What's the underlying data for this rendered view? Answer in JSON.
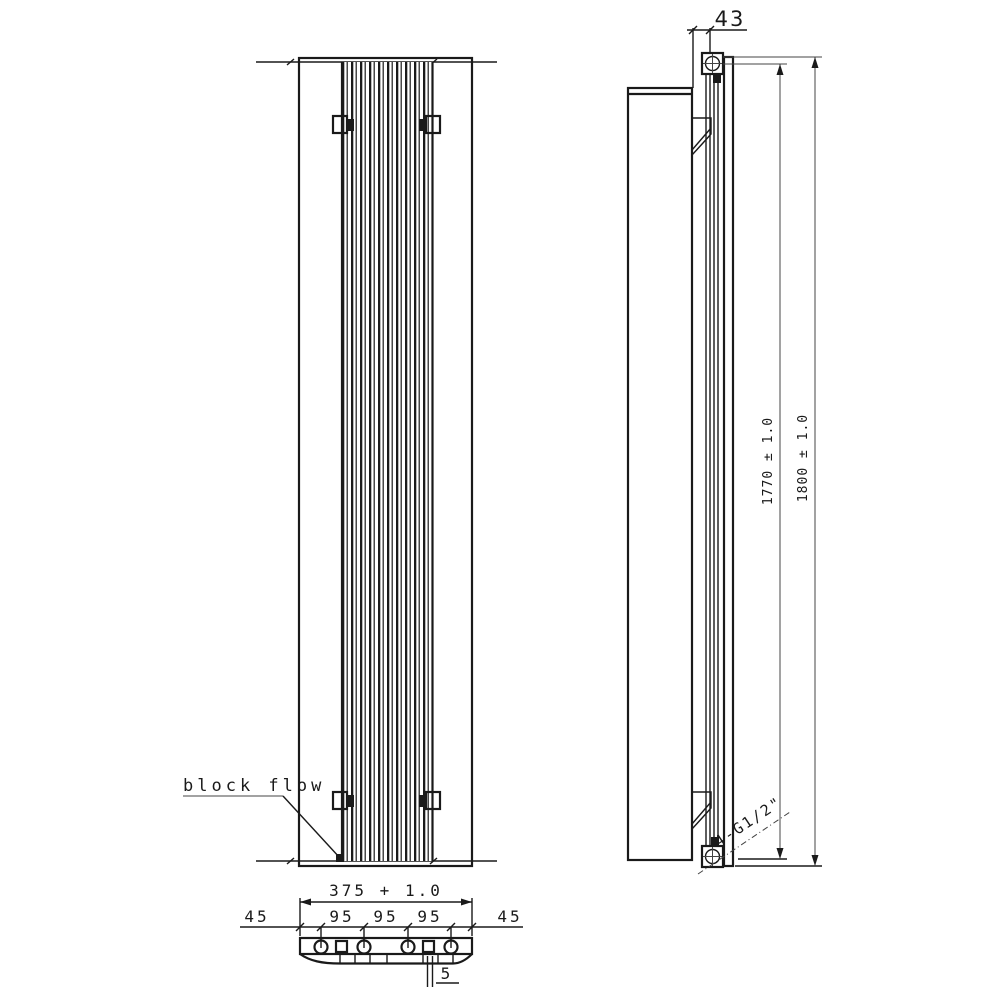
{
  "drawing": {
    "annotations": {
      "block_flow": "block flow",
      "connections": "4-G1/2\""
    },
    "dimensions": {
      "wall_offset": "43",
      "tapping_height": "1770 ± 1.0",
      "overall_height": "1800 ± 1.0",
      "overall_width": "375 + 1.0",
      "edge_left": "45",
      "pitch_1": "95",
      "pitch_2": "95",
      "pitch_3": "95",
      "edge_right": "45",
      "rail_width": "5"
    }
  }
}
